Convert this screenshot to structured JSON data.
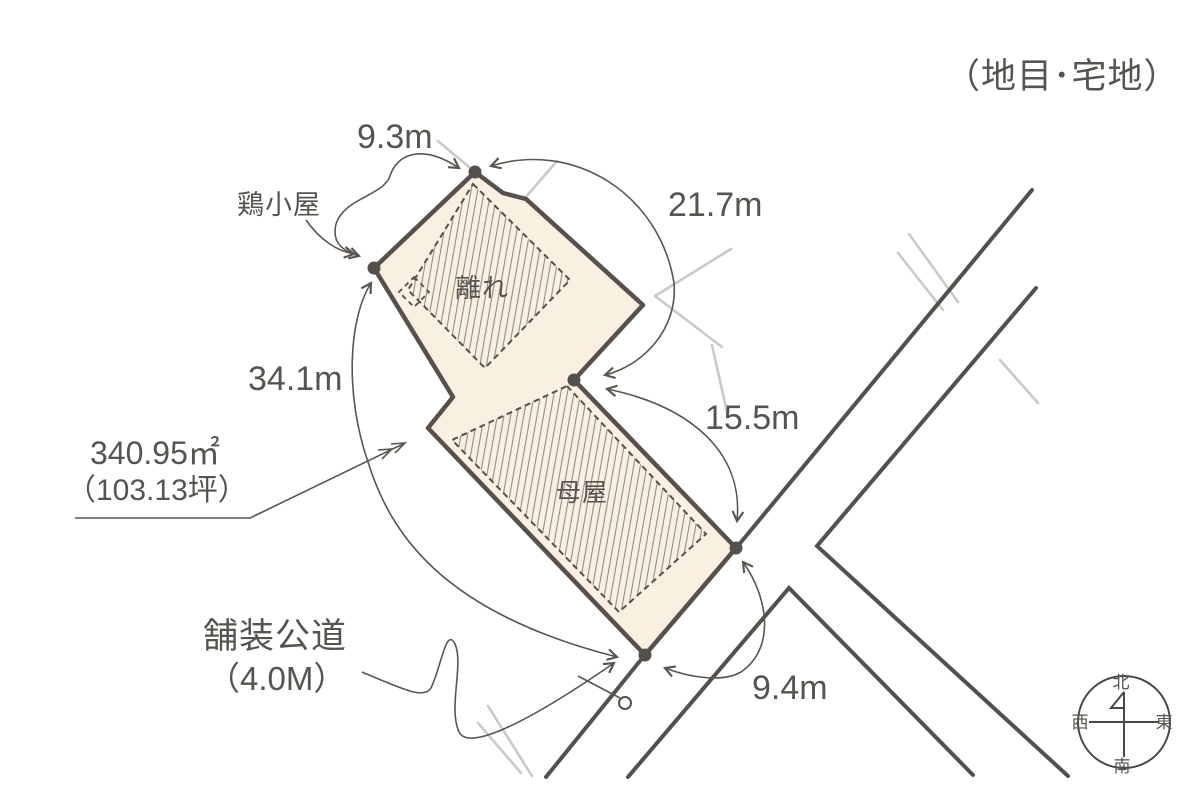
{
  "page": {
    "title": "（地目･宅地）"
  },
  "site_plan": {
    "land": {
      "area_sqm": "340.95㎡",
      "area_tsubo": "（103.13坪）",
      "fill_color": "#faf0e2",
      "outline_color": "#57504b"
    },
    "dimensions": {
      "top_edge": "9.3m",
      "northeast_edge": "21.7m",
      "southeast_edge": "15.5m",
      "west_edge": "34.1m",
      "frontage": "9.4m"
    },
    "buildings": {
      "annex": "離れ",
      "main_house": "母屋",
      "chicken_coop": "鶏小屋"
    },
    "road": {
      "label": "舗装公道",
      "width_label": "（4.0M）"
    },
    "compass": {
      "north": "北",
      "south": "南",
      "east": "東",
      "west": "西"
    },
    "colors": {
      "line_dark": "#55504b",
      "line_light": "#ccc9c6",
      "hatch": "#8f8b88",
      "text": "#57534e"
    }
  }
}
